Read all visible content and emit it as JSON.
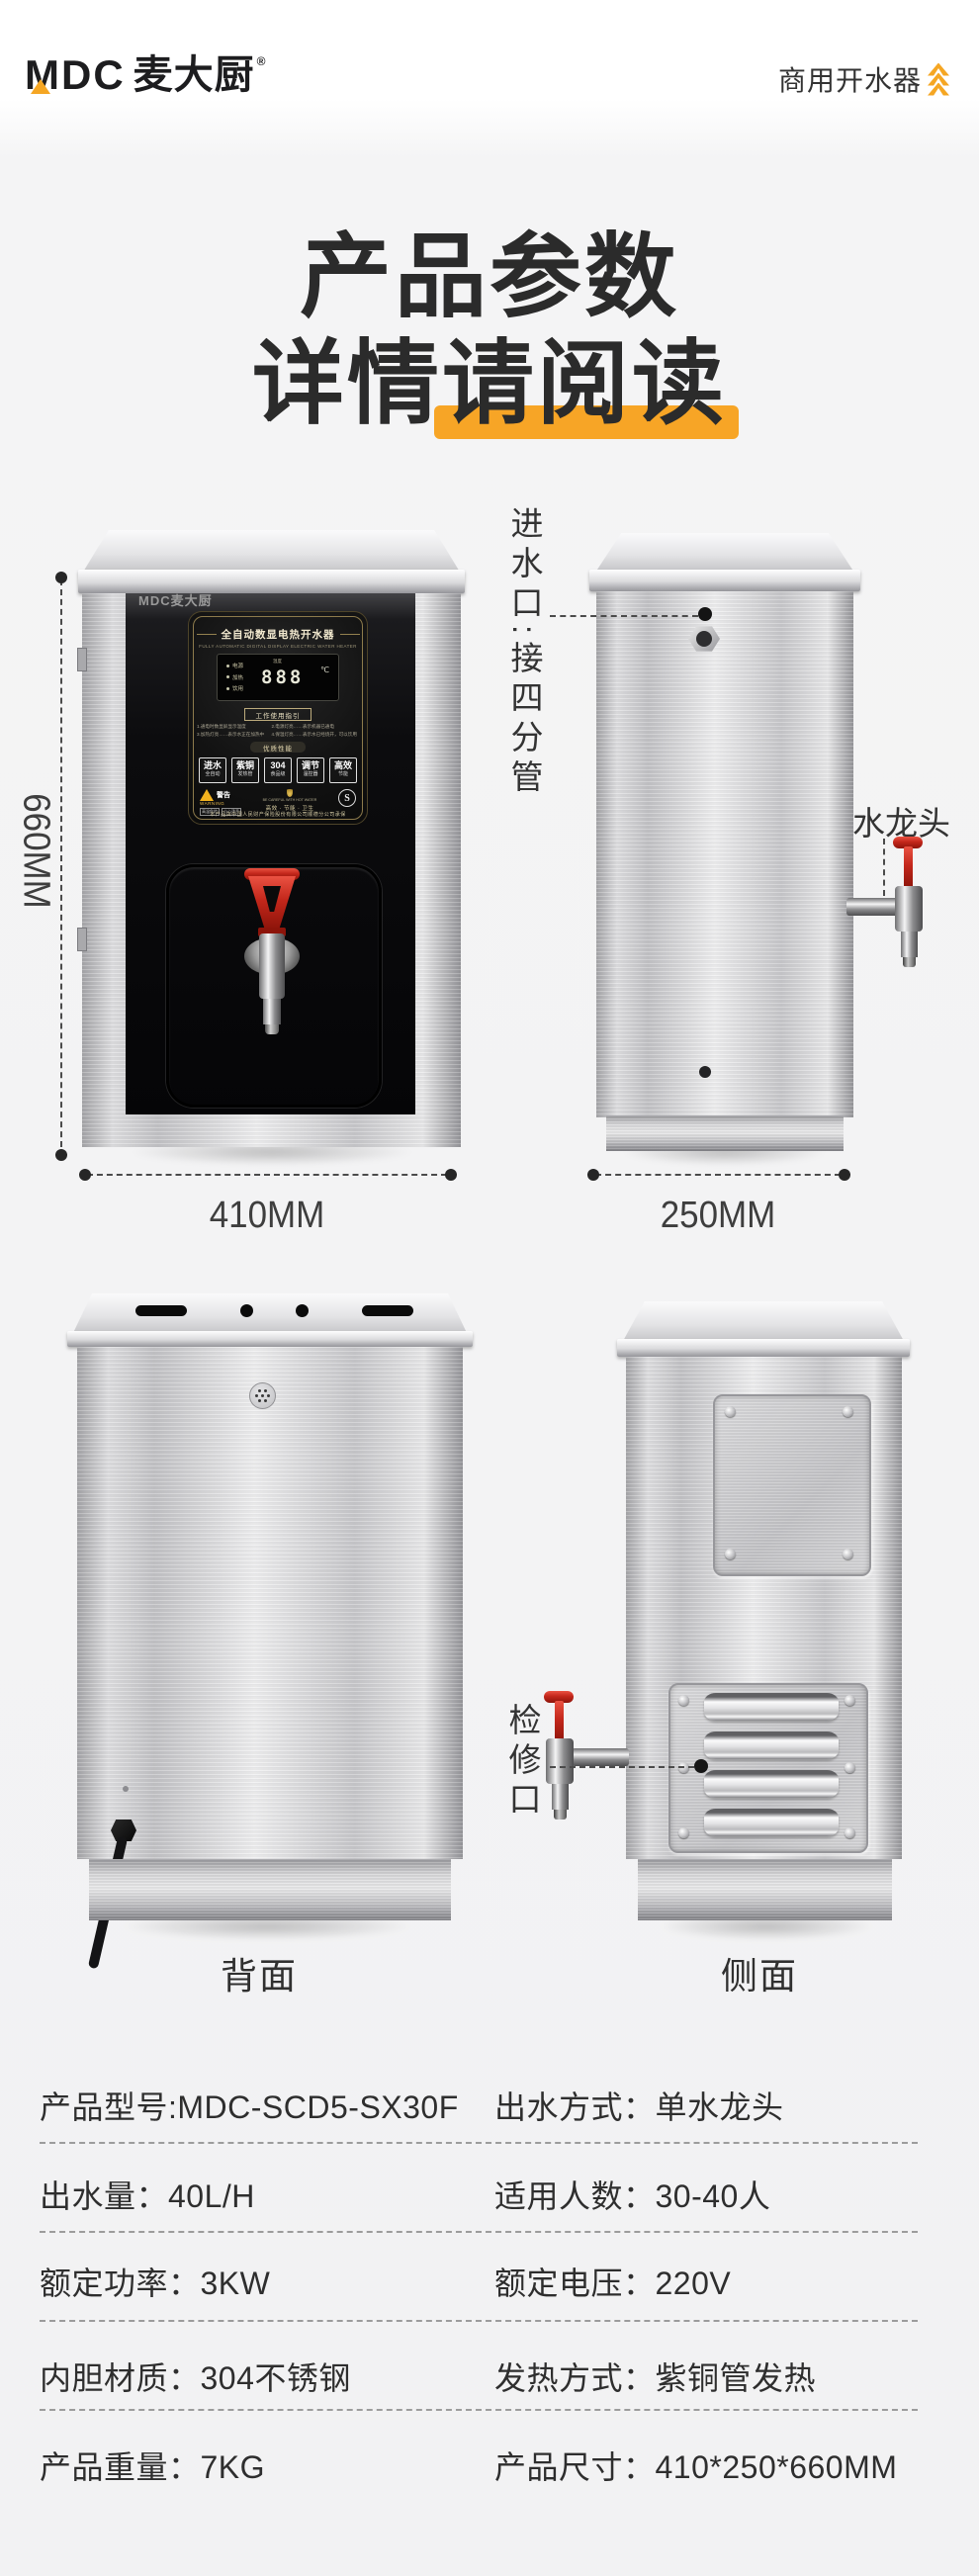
{
  "header": {
    "brand_mdc": "MDC",
    "brand_cn": "麦大厨",
    "brand_reg": "®",
    "category": "商用开水器"
  },
  "title": {
    "line1": "产品参数",
    "line2_prefix": "详情",
    "line2_highlight": "请阅读"
  },
  "colors": {
    "accent_orange": "#F5A623",
    "highlight_orange": "#F7A526",
    "faucet_red": "#C3271B",
    "text_dark": "#2B2B2B"
  },
  "front_panel": {
    "brand_strip": "MDC麦大厨",
    "title": "全自动数显电热开水器",
    "subtitle_en": "FULLY AUTOMATIC DIGITAL DISPLAY ELECTRIC WATER HEATER",
    "indicators": [
      {
        "label": "电源"
      },
      {
        "label": "加热"
      },
      {
        "label": "饮用"
      }
    ],
    "display": {
      "label": "温度",
      "value": "888",
      "unit": "℃"
    },
    "guide_title": "工作使用指引",
    "guide": [
      {
        "text": "1.通电时数显屏显示温度"
      },
      {
        "text": "2.电源灯亮……表示机器已通电"
      },
      {
        "text": "3.加热灯亮……表示水正在加热中"
      },
      {
        "text": "4.保温灯亮……表示水已经烧开，可以饮用"
      }
    ],
    "features_title": "优质性能",
    "features": [
      {
        "big": "进水",
        "small": "全自动"
      },
      {
        "big": "紫铜",
        "small": "发热管"
      },
      {
        "big": "304",
        "small": "食品级"
      },
      {
        "big": "调节",
        "small": "温控器"
      },
      {
        "big": "高效",
        "small": "节能"
      }
    ],
    "warning": {
      "cn": "警告",
      "en": "WARNING",
      "tag1": "高温危险",
      "tag2": "小心烫手",
      "center_en": "BE CAREFUL WITH HOT WATER",
      "center_tags": "高效 · 节能 · 卫生",
      "cert": "S"
    },
    "insurance": "本产品由中国人民财产保险股份有限公司顺德分公司承保"
  },
  "annotations": {
    "height": "660MM",
    "front_width": "410MM",
    "side_width": "250MM",
    "inlet": "进水口:接四分管",
    "faucet": "水龙头",
    "service": "检修口",
    "back_label": "背面",
    "side_label": "侧面"
  },
  "specs": {
    "rows": [
      {
        "left": "产品型号:MDC-SCD5-SX30F",
        "right": "出水方式：单水龙头"
      },
      {
        "left": "出水量：40L/H",
        "right": "适用人数：30-40人"
      },
      {
        "left": "额定功率：3KW",
        "right": "额定电压：220V"
      },
      {
        "left": "内胆材质：304不锈钢",
        "right": "发热方式：紫铜管发热"
      },
      {
        "left": "产品重量：7KG",
        "right": "产品尺寸：410*250*660MM"
      }
    ]
  }
}
